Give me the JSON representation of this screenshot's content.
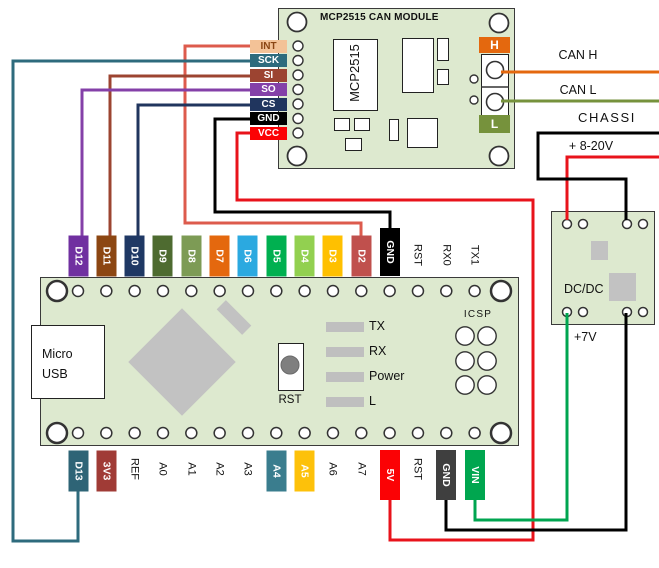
{
  "colors": {
    "pcb": "#dde9cf",
    "board_border": "#3a3a3a",
    "component_gray": "#c2c2c2",
    "led_gray": "#bfbfbf"
  },
  "mcp_module": {
    "title": "MCP2515 CAN MODULE",
    "chip_label": "MCP2515",
    "left_pins": [
      {
        "label": "INT",
        "bg": "#f3c297",
        "fg": "#8a4513"
      },
      {
        "label": "SCK",
        "bg": "#2e6b7d",
        "fg": "#ffffff"
      },
      {
        "label": "SI",
        "bg": "#9c4431",
        "fg": "#ffffff"
      },
      {
        "label": "SO",
        "bg": "#8440a8",
        "fg": "#ffffff"
      },
      {
        "label": "CS",
        "bg": "#20355e",
        "fg": "#ffffff"
      },
      {
        "label": "GND",
        "bg": "#000000",
        "fg": "#ffffff"
      },
      {
        "label": "VCC",
        "bg": "#fb0205",
        "fg": "#ffffff"
      }
    ],
    "terminal_high_label": "H",
    "terminal_low_label": "L",
    "terminal_high_bg": "#e4680e",
    "terminal_low_bg": "#76923c"
  },
  "right_labels": {
    "can_h": "CAN H",
    "can_l": "CAN L",
    "chassis": "CHASSI",
    "supply": "+ 8-20V"
  },
  "dcdc": {
    "label": "DC/DC",
    "output_label": "+7V"
  },
  "arduino": {
    "usb_line1": "Micro",
    "usb_line2": "USB",
    "reset_label": "RST",
    "icsp_label": "ICSP",
    "led_labels": [
      "TX",
      "RX",
      "Power",
      "L"
    ],
    "top_pins": [
      {
        "label": "D12",
        "bg": "#7030a0",
        "fg": "#ffffff"
      },
      {
        "label": "D11",
        "bg": "#8c4612",
        "fg": "#ffffff"
      },
      {
        "label": "D10",
        "bg": "#1f3864",
        "fg": "#ffffff"
      },
      {
        "label": "D9",
        "bg": "#4e6b30",
        "fg": "#ffffff"
      },
      {
        "label": "D8",
        "bg": "#7d9b55",
        "fg": "#ffffff"
      },
      {
        "label": "D7",
        "bg": "#e4680e",
        "fg": "#ffffff"
      },
      {
        "label": "D6",
        "bg": "#2ba9e0",
        "fg": "#ffffff"
      },
      {
        "label": "D5",
        "bg": "#00b050",
        "fg": "#ffffff"
      },
      {
        "label": "D4",
        "bg": "#92d050",
        "fg": "#ffffff"
      },
      {
        "label": "D3",
        "bg": "#ffc000",
        "fg": "#ffffff"
      },
      {
        "label": "D2",
        "bg": "#c0504d",
        "fg": "#ffffff"
      },
      {
        "label": "GND",
        "bg": "#000000",
        "fg": "#ffffff",
        "tall": true
      },
      {
        "label": "RST"
      },
      {
        "label": "RX0"
      },
      {
        "label": "TX1"
      }
    ],
    "bottom_pins": [
      {
        "label": "D13",
        "bg": "#2e6476",
        "fg": "#ffffff"
      },
      {
        "label": "3V3",
        "bg": "#a03b36",
        "fg": "#ffffff"
      },
      {
        "label": "REF"
      },
      {
        "label": "A0"
      },
      {
        "label": "A1"
      },
      {
        "label": "A2"
      },
      {
        "label": "A3"
      },
      {
        "label": "A4",
        "bg": "#3a7d8e",
        "fg": "#ffffff"
      },
      {
        "label": "A5",
        "bg": "#fdc10a",
        "fg": "#ffffff"
      },
      {
        "label": "A6"
      },
      {
        "label": "A7"
      },
      {
        "label": "5V",
        "bg": "#fb0205",
        "fg": "#ffffff",
        "tall": true
      },
      {
        "label": "RST"
      },
      {
        "label": "GND",
        "bg": "#3f3f3f",
        "fg": "#ffffff",
        "tall": true
      },
      {
        "label": "VIN",
        "bg": "#00a64f",
        "fg": "#ffffff",
        "tall": true
      }
    ]
  },
  "wiring": [
    {
      "name": "can-h-wire",
      "signal": "CAN H",
      "color": "#e4680e",
      "points": [
        [
          501,
          72
        ],
        [
          659,
          72
        ]
      ]
    },
    {
      "name": "can-l-wire",
      "signal": "CAN L",
      "color": "#76923c",
      "points": [
        [
          501,
          101
        ],
        [
          659,
          101
        ]
      ]
    },
    {
      "name": "supply-wire",
      "signal": "+ 8-20V",
      "color": "#e8131b",
      "points": [
        [
          659,
          157
        ],
        [
          567,
          157
        ],
        [
          567,
          220
        ]
      ]
    },
    {
      "name": "chassis-wire",
      "signal": "CHASSI",
      "color": "#000000",
      "points": [
        [
          659,
          133
        ],
        [
          538,
          133
        ],
        [
          538,
          179
        ],
        [
          626,
          179
        ],
        [
          626,
          220
        ]
      ]
    },
    {
      "name": "vcc-5v-wire",
      "signal": "VCC to 5V",
      "color": "#e8131b",
      "points": [
        [
          252,
          133
        ],
        [
          237,
          133
        ],
        [
          237,
          200
        ],
        [
          533,
          200
        ],
        [
          533,
          540
        ],
        [
          390,
          540
        ],
        [
          390,
          497
        ]
      ]
    },
    {
      "name": "dcdc-7v-wire",
      "signal": "+7V to VIN",
      "color": "#00a550",
      "points": [
        [
          567,
          313
        ],
        [
          567,
          520
        ],
        [
          475,
          520
        ],
        [
          475,
          497
        ]
      ]
    },
    {
      "name": "dcdc-gnd-wire",
      "signal": "GND to GND",
      "color": "#000000",
      "points": [
        [
          626,
          313
        ],
        [
          626,
          530
        ],
        [
          446,
          530
        ],
        [
          446,
          497
        ]
      ]
    },
    {
      "name": "gnd-wire",
      "signal": "GND to GND",
      "color": "#000000",
      "points": [
        [
          252,
          119
        ],
        [
          215,
          119
        ],
        [
          215,
          212
        ],
        [
          390,
          212
        ],
        [
          390,
          233
        ]
      ]
    },
    {
      "name": "int-wire",
      "signal": "INT to D2",
      "color": "#dd5b4d",
      "points": [
        [
          252,
          46
        ],
        [
          185,
          46
        ],
        [
          185,
          223
        ],
        [
          361,
          223
        ],
        [
          361,
          237
        ]
      ]
    },
    {
      "name": "sck-wire",
      "signal": "SCK to D13",
      "color": "#2e6b7d",
      "points": [
        [
          252,
          61
        ],
        [
          13,
          61
        ],
        [
          13,
          541
        ],
        [
          78,
          541
        ],
        [
          78,
          489
        ]
      ]
    },
    {
      "name": "si-wire",
      "signal": "SI to D11",
      "color": "#9c4431",
      "points": [
        [
          252,
          76
        ],
        [
          110,
          76
        ],
        [
          110,
          237
        ]
      ]
    },
    {
      "name": "so-wire",
      "signal": "SO to D12",
      "color": "#8440a8",
      "points": [
        [
          252,
          90
        ],
        [
          82,
          90
        ],
        [
          82,
          237
        ]
      ]
    },
    {
      "name": "cs-wire",
      "signal": "CS to D10",
      "color": "#20355e",
      "points": [
        [
          252,
          105
        ],
        [
          138,
          105
        ],
        [
          138,
          237
        ]
      ]
    }
  ]
}
